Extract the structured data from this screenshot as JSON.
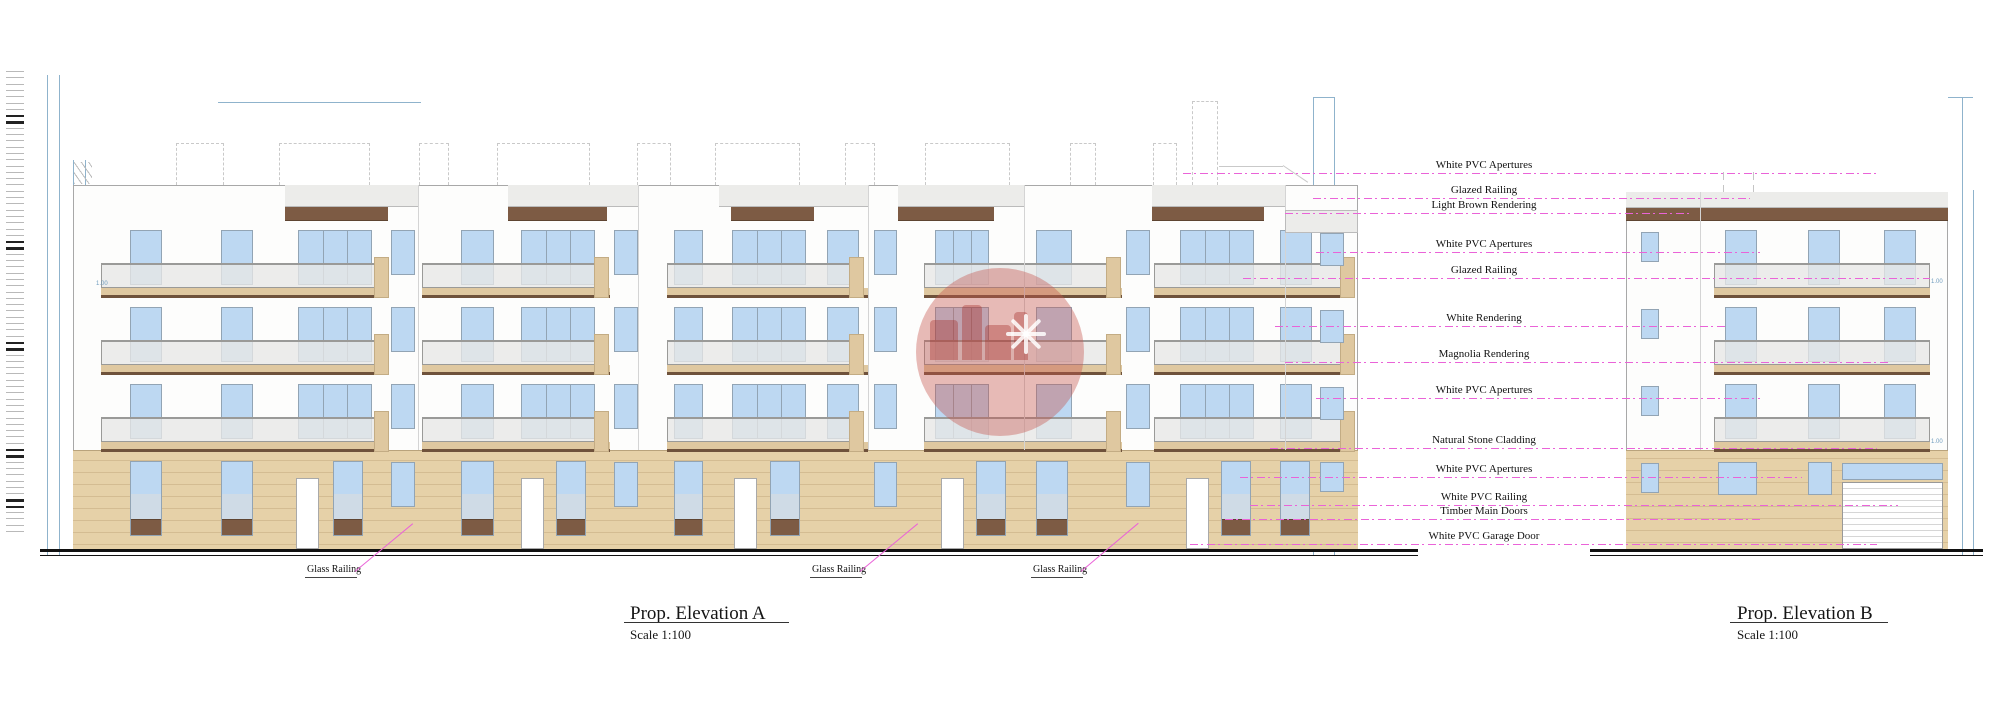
{
  "drawing": {
    "titles": {
      "a": {
        "title": "Prop. Elevation A",
        "scale": "Scale 1:100",
        "x": 630,
        "y": 603,
        "ul": [
          624,
          789,
          622
        ]
      },
      "b": {
        "title": "Prop. Elevation B",
        "scale": "Scale 1:100",
        "x": 1737,
        "y": 603,
        "ul": [
          1730,
          1888,
          622
        ]
      }
    },
    "watermark": {
      "text": "sensaramalta",
      "cx": 1000,
      "cy": 352,
      "r": 84,
      "circle_color": "rgba(198,85,78,0.40)",
      "silhouette_color": "rgba(165,48,42,0.38)",
      "star_color": "rgba(255,255,255,0.85)"
    },
    "annotations": [
      {
        "text": "White PVC Apertures",
        "y": 173,
        "x1": 1183,
        "x2": 1878
      },
      {
        "text": "Glazed Railing",
        "y": 198,
        "x1": 1313,
        "x2": 1750
      },
      {
        "text": "Light Brown Rendering",
        "y": 213,
        "x1": 1285,
        "x2": 1690
      },
      {
        "text": "White PVC Apertures",
        "y": 252,
        "x1": 1316,
        "x2": 1760
      },
      {
        "text": "Glazed Railing",
        "y": 278,
        "x1": 1243,
        "x2": 1930
      },
      {
        "text": "White Rendering",
        "y": 326,
        "x1": 1275,
        "x2": 1725
      },
      {
        "text": "Magnolia Rendering",
        "y": 362,
        "x1": 1285,
        "x2": 1888
      },
      {
        "text": "White PVC Apertures",
        "y": 398,
        "x1": 1316,
        "x2": 1760
      },
      {
        "text": "Natural Stone Cladding",
        "y": 448,
        "x1": 1270,
        "x2": 1877
      },
      {
        "text": "White PVC Apertures",
        "y": 477,
        "x1": 1240,
        "x2": 1802
      },
      {
        "text": "White PVC Railing",
        "y": 505,
        "x1": 1250,
        "x2": 1898
      },
      {
        "text": "Timber Main Doors",
        "y": 519,
        "x1": 1225,
        "x2": 1762
      },
      {
        "text": "White PVC Garage Door",
        "y": 544,
        "x1": 1190,
        "x2": 1877
      }
    ],
    "annotation_center_x": 1484,
    "glass_railing": [
      {
        "text": "Glass Railing",
        "x": 307,
        "y": 564,
        "tx": 413,
        "ty": 523
      },
      {
        "text": "Glass Railing",
        "x": 812,
        "y": 564,
        "tx": 918,
        "ty": 523
      },
      {
        "text": "Glass Railing",
        "x": 1033,
        "y": 564,
        "tx": 1138,
        "ty": 523
      }
    ],
    "dim_labels": [
      {
        "text": "1.00",
        "x": 96,
        "y": 281
      },
      {
        "text": "1.00",
        "x": 1931,
        "y": 279
      },
      {
        "text": "1.00",
        "x": 1931,
        "y": 439
      }
    ],
    "colors": {
      "facade": "#fdfdfc",
      "outline": "#a8a8a8",
      "joint": "#d4d4d4",
      "stone": "#e6d1a8",
      "stone_line": "#d4bc92",
      "slab": "#dfc8a0",
      "slab_edge": "#6f523b",
      "brown": "#7d5b44",
      "brown_dark": "#5e4431",
      "window": "#bdd8f2",
      "window_border": "#92a4b4",
      "pale_glass": "#cfdbe6",
      "rail_glass": "rgba(231,231,229,0.78)",
      "rail_border": "#9a9a98",
      "band_gray": "#ececea",
      "door_white": "#ffffff",
      "pink": "#ea63d8",
      "dim_blue": "#8fb3cc",
      "roof_dash": "#c5c5c5",
      "ground": "#111111"
    },
    "levels": {
      "parapet": 185,
      "floors": [
        221,
        298,
        375
      ],
      "stone_top": 450,
      "ground": 549
    },
    "elevA": {
      "x": [
        73,
        1358
      ],
      "units": [
        {
          "rail": [
            101,
            380
          ],
          "slab": [
            101,
            387
          ],
          "gray": [
            285,
            418
          ],
          "brown": [
            285,
            388
          ],
          "pier": [
            374,
            389
          ],
          "wins": [
            [
              130,
              162
            ],
            [
              221,
              253
            ]
          ],
          "door": [
            298,
            372
          ],
          "strip": [
            391,
            415
          ],
          "stone": {
            "wins": [
              [
                130,
                162
              ],
              [
                221,
                253
              ],
              [
                333,
                363
              ]
            ],
            "door": [
              296,
              319
            ],
            "strip": [
              391,
              415
            ]
          }
        },
        {
          "rail": [
            422,
            603
          ],
          "slab": [
            422,
            610
          ],
          "gray": [
            508,
            638
          ],
          "brown": [
            508,
            607
          ],
          "pier": [
            594,
            609
          ],
          "wins": [
            [
              461,
              494
            ]
          ],
          "door": [
            521,
            595
          ],
          "strip": [
            614,
            638
          ],
          "stone": {
            "wins": [
              [
                461,
                494
              ],
              [
                556,
                586
              ]
            ],
            "door": [
              521,
              544
            ],
            "strip": [
              614,
              638
            ]
          }
        },
        {
          "rail": [
            667,
            861
          ],
          "slab": [
            667,
            868
          ],
          "gray": [
            719,
            868
          ],
          "brown": [
            731,
            814
          ],
          "pier": [
            849,
            864
          ],
          "wins": [
            [
              674,
              703
            ],
            [
              827,
              859
            ]
          ],
          "door": [
            732,
            806
          ],
          "strip": [
            874,
            897
          ],
          "stone": {
            "wins": [
              [
                674,
                703
              ],
              [
                770,
                800
              ]
            ],
            "door": [
              734,
              757
            ],
            "strip": [
              874,
              897
            ]
          }
        },
        {
          "rail": [
            924,
            1118
          ],
          "slab": [
            924,
            1122
          ],
          "gray": [
            898,
            1024
          ],
          "brown": [
            898,
            994
          ],
          "pier": [
            1106,
            1121
          ],
          "wins": [
            [
              1036,
              1072
            ]
          ],
          "door": [
            935,
            989
          ],
          "strip": [
            1126,
            1150
          ],
          "stone": {
            "wins": [
              [
                976,
                1006
              ],
              [
                1036,
                1068
              ]
            ],
            "door": [
              941,
              964
            ],
            "strip": [
              1126,
              1150
            ]
          }
        },
        {
          "rail": [
            1154,
            1348
          ],
          "slab": [
            1154,
            1352
          ],
          "gray": [
            1152,
            1285
          ],
          "brown": [
            1152,
            1264
          ],
          "pier": [
            1340,
            1355
          ],
          "wins": [
            [
              1280,
              1312
            ]
          ],
          "door": [
            1180,
            1254
          ],
          "strip": null,
          "stone": {
            "wins": [
              [
                1221,
                1251
              ],
              [
                1280,
                1310
              ]
            ],
            "door": [
              1186,
              1209
            ],
            "strip": null
          }
        }
      ],
      "end_section": {
        "x": [
          1285,
          1358
        ],
        "gray_y": [
          210,
          233
        ],
        "win": [
          1320,
          1344
        ]
      },
      "ground_line": [
        40,
        1418
      ]
    },
    "elevB": {
      "x": [
        1626,
        1948
      ],
      "joint": 1700,
      "left_wins": [
        1641,
        1659
      ],
      "main_wins": [
        [
          1725,
          1757
        ],
        [
          1808,
          1840
        ],
        [
          1884,
          1916
        ]
      ],
      "rail": [
        1714,
        1930
      ],
      "stone": {
        "left_win": [
          1641,
          1659
        ],
        "wins": [
          [
            1718,
            1757
          ],
          [
            1808,
            1832
          ]
        ],
        "garage": [
          1842,
          1943
        ]
      },
      "ground_line": [
        1590,
        1983
      ]
    },
    "roof": {
      "h_lines": [
        {
          "y": 98,
          "x": [
            82,
            1249
          ]
        },
        {
          "y": 127,
          "x": [
            125,
            1249
          ]
        },
        {
          "y": 133,
          "x": [
            125,
            1249
          ]
        }
      ],
      "boxes": [
        [
          176,
          224
        ],
        [
          279,
          370
        ],
        [
          419,
          449
        ],
        [
          497,
          590
        ],
        [
          637,
          671
        ],
        [
          715,
          800
        ],
        [
          845,
          875
        ],
        [
          925,
          1010
        ],
        [
          1070,
          1096
        ],
        [
          1153,
          1177
        ]
      ],
      "box_y": [
        143,
        185
      ],
      "tall_box": {
        "x": [
          1192,
          1218
        ],
        "y": [
          101,
          185
        ]
      },
      "b_dash": {
        "y": 179,
        "x": [
          1642,
          1858
        ]
      },
      "b_dash_verts": [
        1723,
        1753
      ]
    },
    "dims": {
      "verticals": [
        {
          "x": 47,
          "y1": 75,
          "y2": 556
        },
        {
          "x": 59,
          "y1": 75,
          "y2": 556
        },
        {
          "x": 73,
          "y1": 160,
          "y2": 452
        },
        {
          "x": 85,
          "y1": 160,
          "y2": 300
        },
        {
          "x": 1313,
          "y1": 97,
          "y2": 556
        },
        {
          "x": 1334,
          "y1": 97,
          "y2": 556
        },
        {
          "x": 1962,
          "y1": 97,
          "y2": 556
        },
        {
          "x": 1973,
          "y1": 190,
          "y2": 556
        }
      ],
      "horizontals": [
        {
          "y": 102,
          "x1": 218,
          "x2": 421
        },
        {
          "y": 97,
          "x1": 1313,
          "x2": 1334
        },
        {
          "y": 97,
          "x1": 1948,
          "x2": 1973
        },
        {
          "y": 489,
          "x1": 1846,
          "x2": 1939
        }
      ],
      "garage_vert": {
        "x": 1935,
        "y1": 489,
        "y2": 545
      }
    },
    "staff": {
      "x": 6,
      "w": 18,
      "y": 71,
      "count": 74,
      "step": 6.3,
      "dark": [
        7,
        8,
        27,
        28,
        43,
        44,
        60,
        61,
        68,
        69
      ]
    }
  }
}
